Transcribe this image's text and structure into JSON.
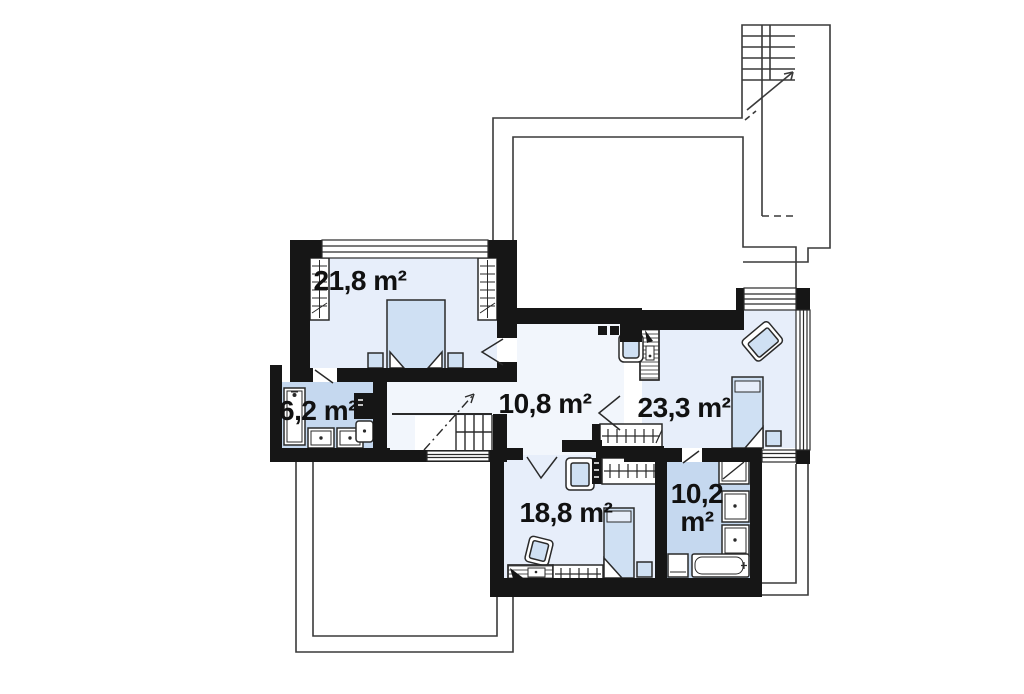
{
  "page": {
    "kind": "architectural floor plan (upper storey)",
    "background": "#ffffff"
  },
  "colors": {
    "wall": "#161616",
    "room_fill": "#e7eefa",
    "bathroom_fill": "#c5d8ef",
    "hall_fill": "#f2f6fc",
    "furniture_fill": "#cfe0f3",
    "thin_line": "#3a3a3a",
    "label_text": "#111111"
  },
  "rooms": [
    {
      "id": "bedroom-top-left",
      "kind": "bedroom",
      "label": "21,8 m²",
      "furniture": [
        "double-bed",
        "nightstand-left",
        "nightstand-right",
        "wardrobe-left",
        "wardrobe-right",
        "window-top"
      ]
    },
    {
      "id": "bathroom-left",
      "kind": "bathroom",
      "label": "6,2 m²",
      "furniture": [
        "shower-cabin",
        "washbasin-1",
        "washbasin-2",
        "toilet-with-cistern"
      ]
    },
    {
      "id": "hallway",
      "kind": "hall with staircase",
      "label": "10,8 m²",
      "furniture": [
        "staircase",
        "sideboard-shelf",
        "window-bottom"
      ]
    },
    {
      "id": "bedroom-right",
      "kind": "bedroom / study",
      "label": "23,3 m²",
      "furniture": [
        "desk",
        "desk-chair",
        "armchair",
        "single-bed",
        "nightstand",
        "built-in-wardrobe",
        "corner-window"
      ]
    },
    {
      "id": "bedroom-bottom",
      "kind": "bedroom / study",
      "label": "18,8 m²",
      "furniture": [
        "armchair-top",
        "armchair-near-desk",
        "desk-with-lamp",
        "wardrobe-strip",
        "single-bed",
        "nightstand",
        "built-in-wardrobe"
      ]
    },
    {
      "id": "bathroom-right",
      "kind": "bathroom",
      "label": "10,2 m²",
      "label_value": "10,2",
      "label_unit": "m²",
      "furniture": [
        "shower-cabin",
        "washbasin-1",
        "washbasin-2",
        "bathtub",
        "toilet"
      ]
    }
  ],
  "outside": {
    "features": [
      "external-staircase-top-right",
      "roof-void-outline-top",
      "terrace-outline-bottom-left",
      "eaves-outline-bottom-right"
    ]
  }
}
